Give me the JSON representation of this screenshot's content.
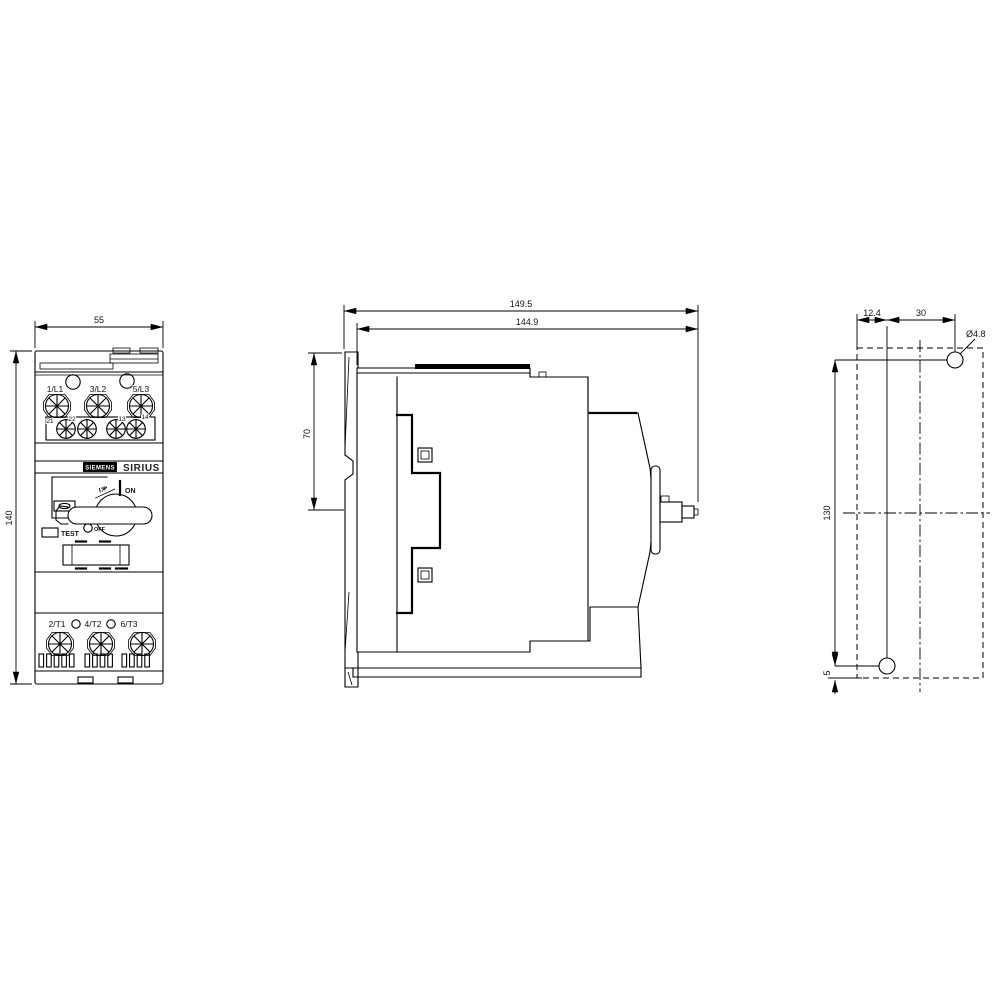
{
  "meta": {
    "drawing_type": "dimension drawing, 3 views",
    "line_color": "#000000",
    "background": "#ffffff"
  },
  "front_view": {
    "width_dim": "55",
    "height_dim": "140",
    "brand": "SIEMENS",
    "series": "SIRIUS",
    "line_terminals": [
      "1/L1",
      "3/L2",
      "5/L3"
    ],
    "aux_terminals": [
      "21",
      "22",
      "13",
      "14"
    ],
    "load_terminals": [
      "2/T1",
      "4/T2",
      "6/T3"
    ],
    "on_label": "ON",
    "off_label": "OFF",
    "test_label": "TEST",
    "dial_marking": "I≫"
  },
  "side_view": {
    "depth_total": "149.5",
    "depth_body": "144.9",
    "upper_depth": "70"
  },
  "drill_view": {
    "offset_x": "12.4",
    "hole_span_x": "30",
    "hole_dia": "Ø4.8",
    "hole_span_y": "130",
    "bottom_offset": "5"
  }
}
